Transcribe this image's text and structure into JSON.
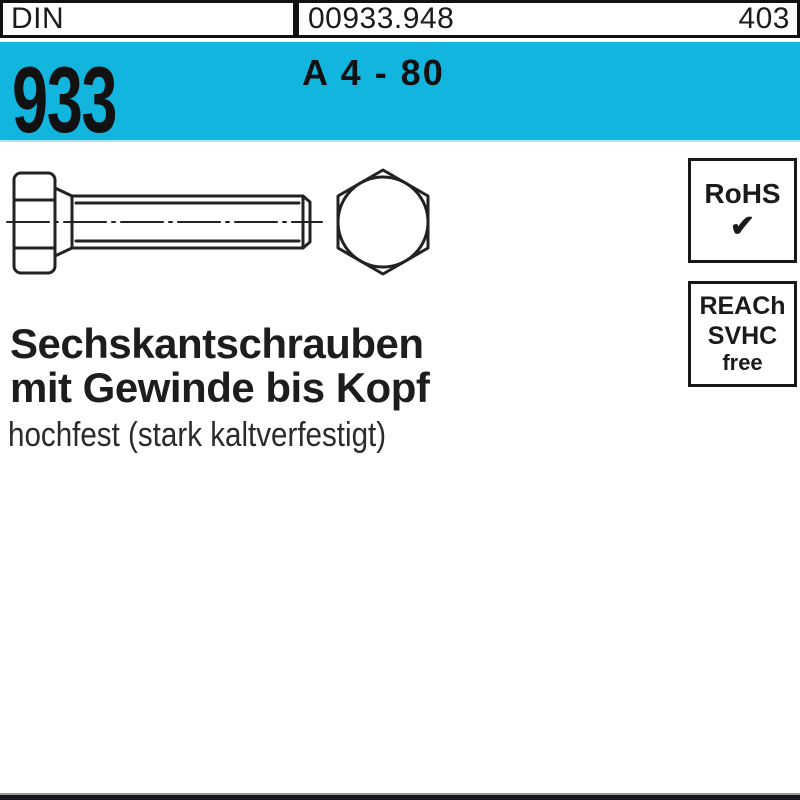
{
  "header": {
    "din_label": "DIN",
    "article_number": "00933.948",
    "page_number": "403"
  },
  "banner": {
    "standard_number": "933",
    "material_grade": "A 4 - 80",
    "background_color": "#12b5dd"
  },
  "compliance": {
    "rohs_label": "RoHS",
    "rohs_checkmark": "✔",
    "reach_lines": [
      "REACh",
      "SVHC",
      "free"
    ]
  },
  "product": {
    "title_line1": "Sechskantschrauben",
    "title_line2": "mit Gewinde bis Kopf",
    "subtitle": "hochfest (stark kaltverfestigt)"
  },
  "drawing": {
    "side_view_icon": "hex-bolt-side-view-icon",
    "front_view_icon": "hex-bolt-head-front-view-icon"
  },
  "colors": {
    "banner_blue": "#12b5dd",
    "ink_black": "#1d1d1d",
    "bottom_bar_dark": "#16161e"
  }
}
